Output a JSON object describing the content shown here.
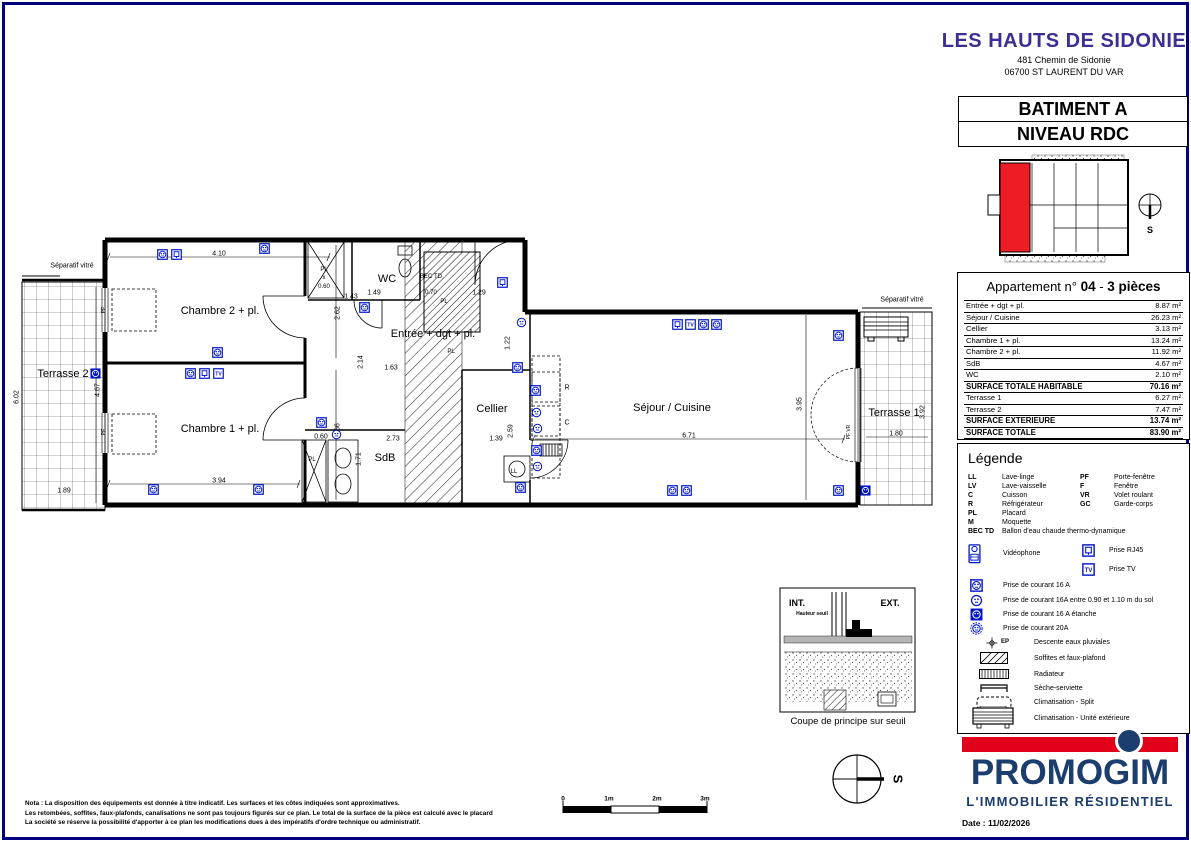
{
  "header": {
    "project": "LES HAUTS DE SIDONIE",
    "address1": "481 Chemin de Sidonie",
    "address2": "06700 ST LAURENT DU VAR"
  },
  "title_block": {
    "building": "BATIMENT A",
    "level": "NIVEAU RDC"
  },
  "apartment": {
    "title_prefix": "Appartement n°",
    "number": "04",
    "separator": "-",
    "type_label": "3 pièces",
    "rows": [
      {
        "label": "Entrée + dgt + pl.",
        "value": "8.87 m²",
        "bold": false
      },
      {
        "label": "Séjour / Cuisine",
        "value": "26.23 m²",
        "bold": false
      },
      {
        "label": "Cellier",
        "value": "3.13 m²",
        "bold": false
      },
      {
        "label": "Chambre 1 + pl.",
        "value": "13.24 m²",
        "bold": false
      },
      {
        "label": "Chambre 2 + pl.",
        "value": "11.92 m²",
        "bold": false
      },
      {
        "label": "SdB",
        "value": "4.67 m²",
        "bold": false
      },
      {
        "label": "WC",
        "value": "2.10 m²",
        "bold": false
      },
      {
        "label": "SURFACE TOTALE HABITABLE",
        "value": "70.16 m²",
        "bold": true
      },
      {
        "label": "Terrasse 1",
        "value": "6.27 m²",
        "bold": false
      },
      {
        "label": "Terrasse 2",
        "value": "7.47 m²",
        "bold": false
      },
      {
        "label": "SURFACE EXTERIEURE",
        "value": "13.74 m²",
        "bold": true
      },
      {
        "label": "SURFACE TOTALE",
        "value": "83.90 m²",
        "bold": true
      }
    ]
  },
  "legend": {
    "title": "Légende",
    "abbr_left": [
      [
        "LL",
        "Lave-linge"
      ],
      [
        "LV",
        "Lave-vaisselle"
      ],
      [
        "C",
        "Cuisson"
      ],
      [
        "R",
        "Réfrigérateur"
      ],
      [
        "PL",
        "Placard"
      ],
      [
        "M",
        "Moquette"
      ],
      [
        "BEC TD",
        "Ballon d'eau chaude thermo-dynamique"
      ]
    ],
    "abbr_right": [
      [
        "PF",
        "Porte-fenêtre"
      ],
      [
        "F",
        "Fenêtre"
      ],
      [
        "VR",
        "Volet roulant"
      ],
      [
        "GC",
        "Garde-corps"
      ]
    ],
    "electrical": [
      {
        "icon": "v",
        "label": "Vidéophone"
      },
      {
        "icon": "r",
        "label": "Prise RJ45"
      },
      {
        "icon": "t",
        "label": "Prise TV"
      },
      {
        "icon": "o",
        "label": "Prise de courant 16 A"
      },
      {
        "icon": "c",
        "label": "Prise de courant 16A entre 0.90 et 1.10 m du sol"
      },
      {
        "icon": "e",
        "label": "Prise de courant 16 A étanche"
      },
      {
        "icon": "a",
        "label": "Prise de courant 20A"
      }
    ],
    "ep_code": "EP",
    "symbols": [
      {
        "icon": "ep",
        "label": "Descente eaux pluviales"
      },
      {
        "icon": "hat",
        "label": "Soffites et faux-plafond"
      },
      {
        "icon": "rad",
        "label": "Radiateur"
      },
      {
        "icon": "ses",
        "label": "Sèche-serviette"
      },
      {
        "icon": "spl",
        "label": "Climatisation - Split"
      },
      {
        "icon": "uni",
        "label": "Climatisation - Unité extérieure"
      }
    ]
  },
  "branding": {
    "name": "PROMOGIM",
    "tagline": "L'IMMOBILIER RÉSIDENTIEL",
    "date": "Date : 11/02/2026",
    "red": "#e2001a",
    "navy": "#1c3e6e"
  },
  "colors": {
    "icon_blue": "#0014cc",
    "header_purple": "#3b2f94",
    "keyplan_red": "#ee1c25",
    "frame_blue": "#00007d"
  },
  "plan": {
    "rooms": [
      {
        "t": "Chambre 2 + pl.",
        "x": 220,
        "y": 311
      },
      {
        "t": "Chambre 1 + pl.",
        "x": 220,
        "y": 429
      },
      {
        "t": "Terrasse 2",
        "x": 63,
        "y": 374
      },
      {
        "t": "Terrasse 1",
        "x": 894,
        "y": 413
      },
      {
        "t": "Séjour / Cuisine",
        "x": 672,
        "y": 408
      },
      {
        "t": "Cellier",
        "x": 492,
        "y": 409
      },
      {
        "t": "Entrée + dgt + pl.",
        "x": 433,
        "y": 334
      },
      {
        "t": "WC",
        "x": 387,
        "y": 279
      },
      {
        "t": "SdB",
        "x": 385,
        "y": 458
      }
    ],
    "small_labels": [
      {
        "t": "Séparatif vitré",
        "x": 72,
        "y": 266,
        "s": 7
      },
      {
        "t": "Séparatif vitré",
        "x": 902,
        "y": 300,
        "s": 7
      },
      {
        "t": "PL",
        "x": 324,
        "y": 270,
        "s": 6
      },
      {
        "t": "x",
        "x": 324,
        "y": 278,
        "s": 6
      },
      {
        "t": "0.60",
        "x": 324,
        "y": 287,
        "s": 6
      },
      {
        "t": "BEC TD",
        "x": 431,
        "y": 277,
        "s": 6
      },
      {
        "t": "0.70",
        "x": 431,
        "y": 293,
        "s": 6
      },
      {
        "t": "PL",
        "x": 444,
        "y": 302,
        "s": 6
      },
      {
        "t": "PL",
        "x": 451,
        "y": 352,
        "s": 6
      },
      {
        "t": "PL",
        "x": 312,
        "y": 460,
        "s": 6
      },
      {
        "t": "R",
        "x": 567,
        "y": 388,
        "s": 7
      },
      {
        "t": "C",
        "x": 567,
        "y": 423,
        "s": 7
      },
      {
        "t": "LL",
        "x": 514,
        "y": 472,
        "s": 6
      },
      {
        "t": "PF VR",
        "x": 849,
        "y": 432,
        "s": 5,
        "v": 1
      },
      {
        "t": "PF",
        "x": 104,
        "y": 310,
        "s": 5,
        "v": 1
      },
      {
        "t": "PF",
        "x": 104,
        "y": 432,
        "s": 5,
        "v": 1
      }
    ],
    "dimensions": [
      {
        "t": "4.10",
        "x": 219,
        "y": 254
      },
      {
        "t": "1.43",
        "x": 351,
        "y": 297
      },
      {
        "t": "1.49",
        "x": 374,
        "y": 293
      },
      {
        "t": "1.29",
        "x": 479,
        "y": 293
      },
      {
        "t": "2.62",
        "x": 338,
        "y": 313,
        "v": 1
      },
      {
        "t": "2.14",
        "x": 361,
        "y": 362,
        "v": 1
      },
      {
        "t": "1.63",
        "x": 391,
        "y": 368
      },
      {
        "t": "1.22",
        "x": 508,
        "y": 343,
        "v": 1
      },
      {
        "t": "3.94",
        "x": 219,
        "y": 481
      },
      {
        "t": "2.66",
        "x": 338,
        "y": 430,
        "v": 1
      },
      {
        "t": "1.89",
        "x": 64,
        "y": 491
      },
      {
        "t": "4.67",
        "x": 98,
        "y": 390,
        "v": 1
      },
      {
        "t": "6.02",
        "x": 17,
        "y": 397,
        "v": 1
      },
      {
        "t": "2.73",
        "x": 393,
        "y": 439
      },
      {
        "t": "1.71",
        "x": 359,
        "y": 459,
        "v": 1
      },
      {
        "t": "0.60",
        "x": 321,
        "y": 437
      },
      {
        "t": "1.39",
        "x": 496,
        "y": 439
      },
      {
        "t": "2.59",
        "x": 511,
        "y": 431,
        "v": 1
      },
      {
        "t": "6.71",
        "x": 689,
        "y": 436
      },
      {
        "t": "3.95",
        "x": 800,
        "y": 404,
        "v": 1
      },
      {
        "t": "1.80",
        "x": 896,
        "y": 434
      },
      {
        "t": "3.92",
        "x": 923,
        "y": 412,
        "v": 1
      }
    ],
    "sockets": [
      {
        "x": 162,
        "y": 254,
        "k": "o"
      },
      {
        "x": 176,
        "y": 254,
        "k": "r"
      },
      {
        "x": 264,
        "y": 248,
        "k": "o"
      },
      {
        "x": 364,
        "y": 307,
        "k": "o"
      },
      {
        "x": 502,
        "y": 282,
        "k": "r"
      },
      {
        "x": 217,
        "y": 352,
        "k": "o"
      },
      {
        "x": 190,
        "y": 373,
        "k": "o"
      },
      {
        "x": 204,
        "y": 373,
        "k": "r"
      },
      {
        "x": 218,
        "y": 373,
        "k": "t"
      },
      {
        "x": 95,
        "y": 373,
        "k": "e"
      },
      {
        "x": 153,
        "y": 489,
        "k": "o"
      },
      {
        "x": 258,
        "y": 489,
        "k": "o"
      },
      {
        "x": 321,
        "y": 422,
        "k": "o"
      },
      {
        "x": 336,
        "y": 434,
        "k": "c"
      },
      {
        "x": 521,
        "y": 322,
        "k": "c"
      },
      {
        "x": 677,
        "y": 324,
        "k": "r"
      },
      {
        "x": 690,
        "y": 324,
        "k": "t"
      },
      {
        "x": 703,
        "y": 324,
        "k": "o"
      },
      {
        "x": 716,
        "y": 324,
        "k": "o"
      },
      {
        "x": 838,
        "y": 335,
        "k": "o"
      },
      {
        "x": 517,
        "y": 367,
        "k": "o"
      },
      {
        "x": 535,
        "y": 390,
        "k": "o"
      },
      {
        "x": 536,
        "y": 412,
        "k": "c"
      },
      {
        "x": 537,
        "y": 428,
        "k": "c"
      },
      {
        "x": 536,
        "y": 450,
        "k": "o"
      },
      {
        "x": 537,
        "y": 466,
        "k": "c"
      },
      {
        "x": 520,
        "y": 487,
        "k": "o"
      },
      {
        "x": 672,
        "y": 490,
        "k": "o"
      },
      {
        "x": 686,
        "y": 490,
        "k": "o"
      },
      {
        "x": 838,
        "y": 490,
        "k": "o"
      },
      {
        "x": 865,
        "y": 490,
        "k": "e"
      }
    ]
  },
  "coupe": {
    "int_label": "INT.",
    "ext_label": "EXT.",
    "note": "Hauteur seuil",
    "caption": "Coupe de principe sur seuil"
  },
  "compass_main": {
    "label": "S"
  },
  "compass_key": {
    "label": "S"
  },
  "scalebar": {
    "labels": [
      {
        "t": "0",
        "x": 563
      },
      {
        "t": "1m",
        "x": 609
      },
      {
        "t": "2m",
        "x": 657
      },
      {
        "t": "3m",
        "x": 705
      }
    ]
  },
  "notes": [
    "Nota : La disposition des équipements est donnée à titre indicatif. Les surfaces et les côtes indiquées sont approximatives.",
    "Les retombées, soffites, faux-plafonds, canalisations ne sont pas toujours figurés sur ce plan. Le total de la surface de la pièce est calculé avec le placard",
    "La société se réserve la possibilité d'apporter à ce plan les modifications dues à des impératifs d'ordre technique ou administratif."
  ]
}
